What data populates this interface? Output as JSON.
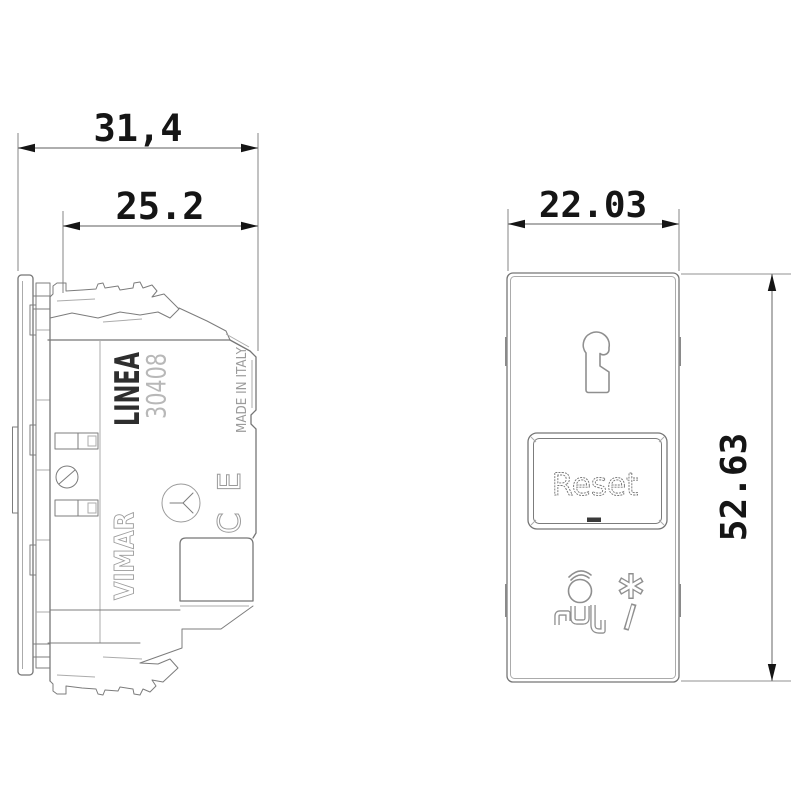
{
  "drawing": {
    "side_view": {
      "brand": "LINEA",
      "model": "30408",
      "origin": "MADE IN ITALY",
      "logo": "VIMAR",
      "certification": "CE",
      "dim_overall_width": "31,4",
      "dim_module_width": "25.2"
    },
    "front_view": {
      "button_label": "Reset",
      "dim_width": "22.03",
      "dim_height": "52.63",
      "icons": [
        "door-hanger-icon",
        "nurse-cap-head-icon",
        "asterisk-icon",
        "pull-cord-slash-icon"
      ]
    },
    "colors": {
      "background": "#ffffff",
      "outline": "#767676",
      "dimension_text": "#151515"
    }
  }
}
